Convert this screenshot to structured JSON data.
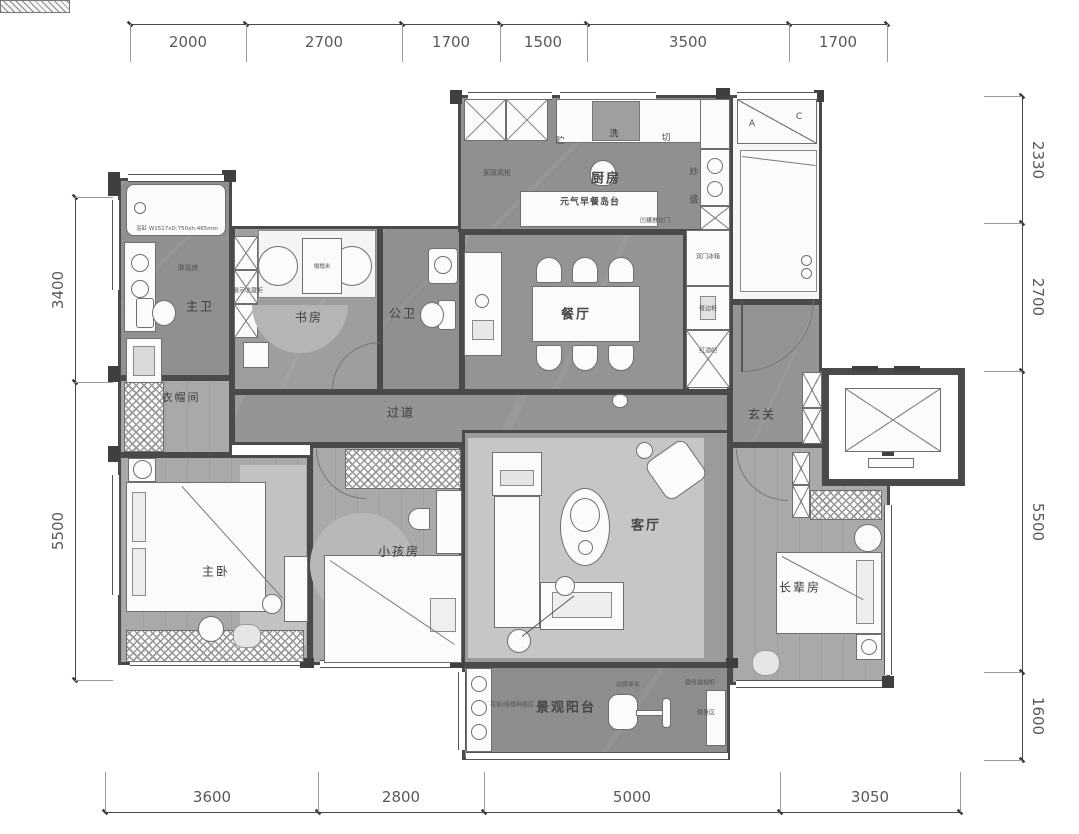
{
  "dims": {
    "top": [
      "2000",
      "2700",
      "1700",
      "1500",
      "3500",
      "1700"
    ],
    "right": [
      "2330",
      "2700",
      "5500",
      "1600"
    ],
    "left": [
      "3400",
      "5500"
    ],
    "bottom": [
      "3600",
      "2800",
      "5000",
      "3050"
    ]
  },
  "rooms": {
    "kitchen": "厨房",
    "dining": "餐厅",
    "master_bath": "主卫",
    "study": "书房",
    "guest_bath": "公卫",
    "cloakroom": "衣帽间",
    "hallway": "过道",
    "foyer": "玄关",
    "master_bedroom": "主卧",
    "kids_room": "小孩房",
    "living": "客厅",
    "elder_room": "长辈房",
    "balcony": "景观阳台"
  },
  "features": {
    "breakfast_island": "元气早餐岛台",
    "housekeeping_cabinet": "家政高柜",
    "display_cabinet": "展示收藏柜",
    "tatami": "榻榻米",
    "sliding_door": "凹槽推拉门",
    "fridge": "双门冰箱",
    "sideboard": "餐边柜",
    "wine_bar": "红酒吧",
    "bathtub_spec": "浴缸 W1517xD:750xh:465mm",
    "shower": "淋浴房",
    "plant_area": "花架/绿植种植区",
    "spin_bike": "动感单车",
    "fitness_cabinet": "健身器械柜",
    "fitness_area": "健身区"
  },
  "kitchen_workflow": [
    "贮",
    "洗",
    "切",
    "炒",
    "盛"
  ],
  "stair_marks": [
    "A",
    "C"
  ],
  "colors": {
    "wall": "#4a4a4a",
    "tile_floor": "#909090",
    "wood_floor": "#a9a9a9",
    "rug": "#c6c6c6",
    "balcony_floor": "#8d8d8d",
    "dim_text": "#595959"
  }
}
